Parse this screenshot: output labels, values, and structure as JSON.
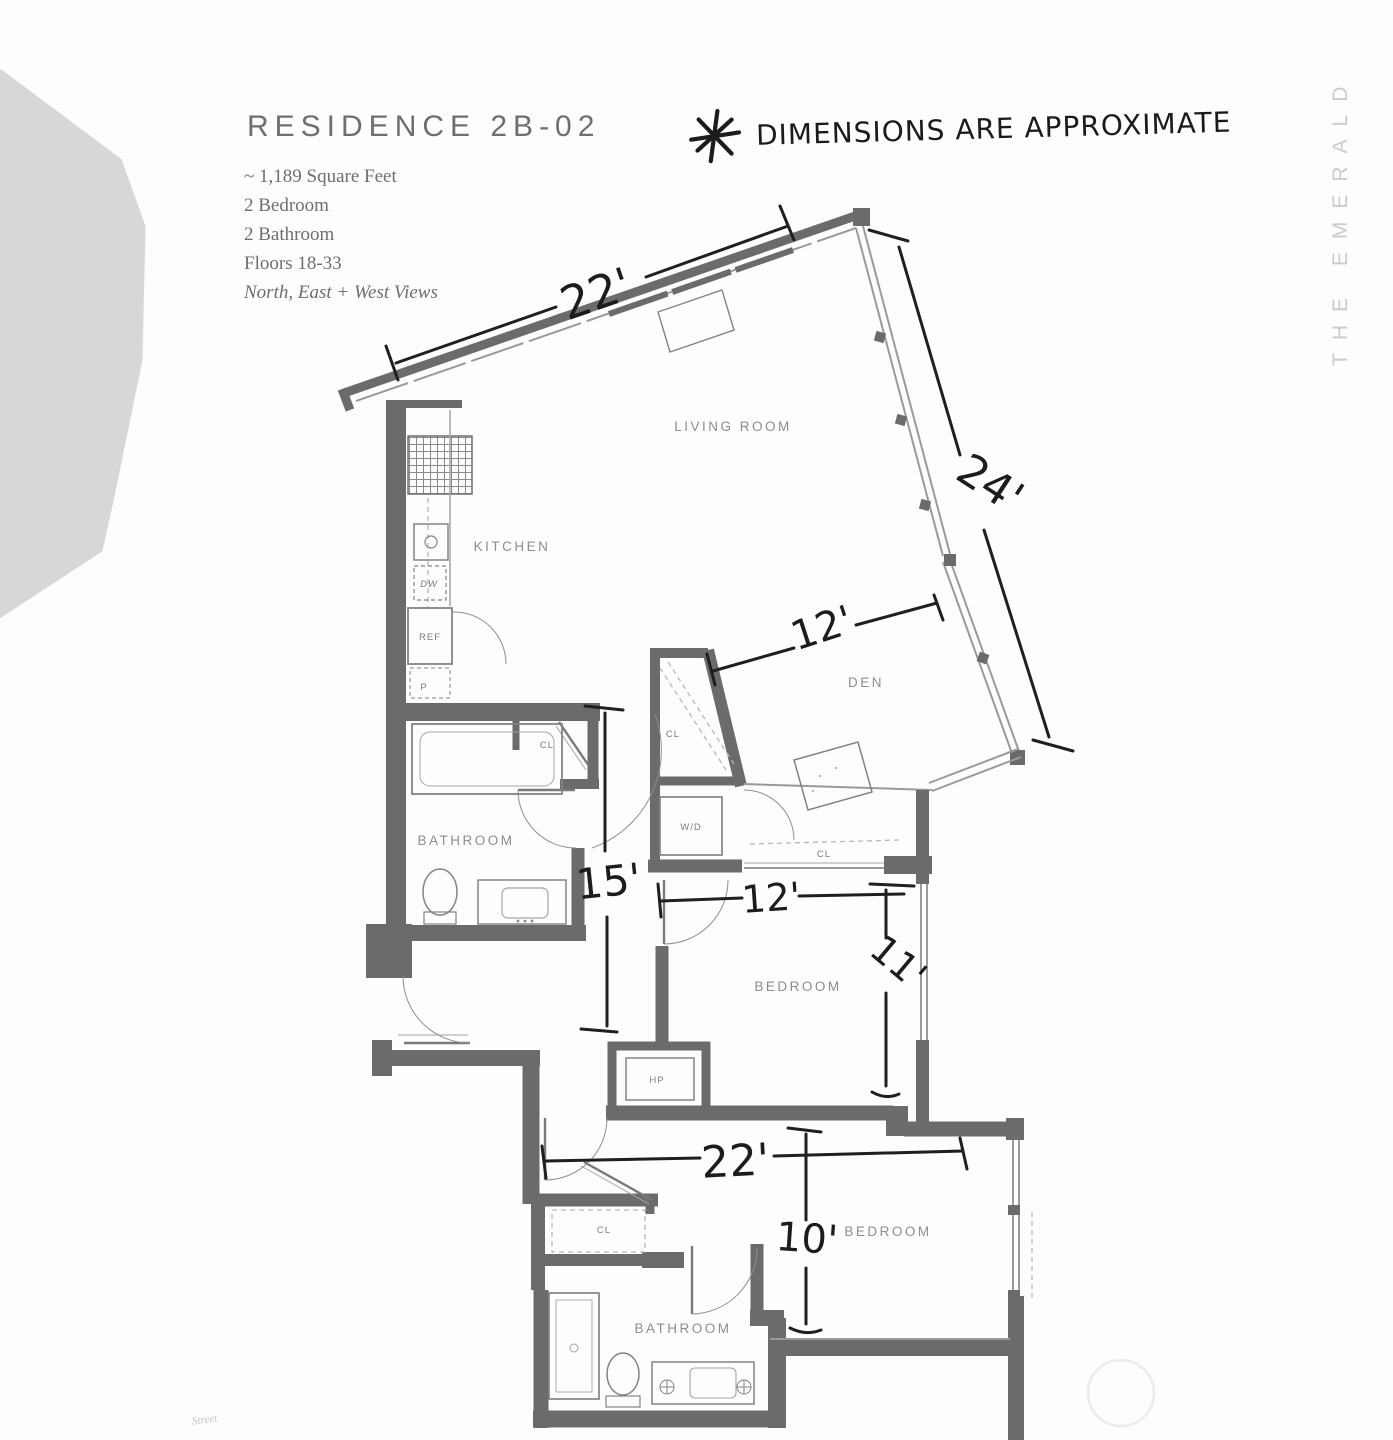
{
  "header": {
    "title": "RESIDENCE 2B-02",
    "specs": [
      "~ 1,189 Square Feet",
      "2 Bedroom",
      "2 Bathroom",
      "Floors 18-33"
    ],
    "views_note": "North, East + West Views",
    "annotation": "DIMENSIONS ARE APPROXIMATE"
  },
  "brand": {
    "vertical_text": "THE EMERALD"
  },
  "floorplan": {
    "rooms": {
      "living_room": "LIVING ROOM",
      "kitchen": "KITCHEN",
      "den": "DEN",
      "bathroom_upper": "BATHROOM",
      "bedroom_middle": "BEDROOM",
      "bedroom_lower": "BEDROOM",
      "bathroom_lower": "BATHROOM"
    },
    "closets": {
      "entry": "CL",
      "den": "CL",
      "bedroom_middle": "CL",
      "bedroom_lower": "CL"
    },
    "fixtures": {
      "refrigerator": "REF",
      "dishwasher": "DW",
      "pantry": "P",
      "washer_dryer": "W/D",
      "heat_pump": "HP"
    },
    "dimensions": {
      "living_width": "22'",
      "living_depth": "24'",
      "den_width": "12'",
      "hall_depth": "15'",
      "bedroom_middle_width": "12'",
      "bedroom_middle_depth": "11'",
      "lower_width": "22'",
      "bedroom_lower_depth": "10'"
    },
    "footnote": "Street"
  }
}
